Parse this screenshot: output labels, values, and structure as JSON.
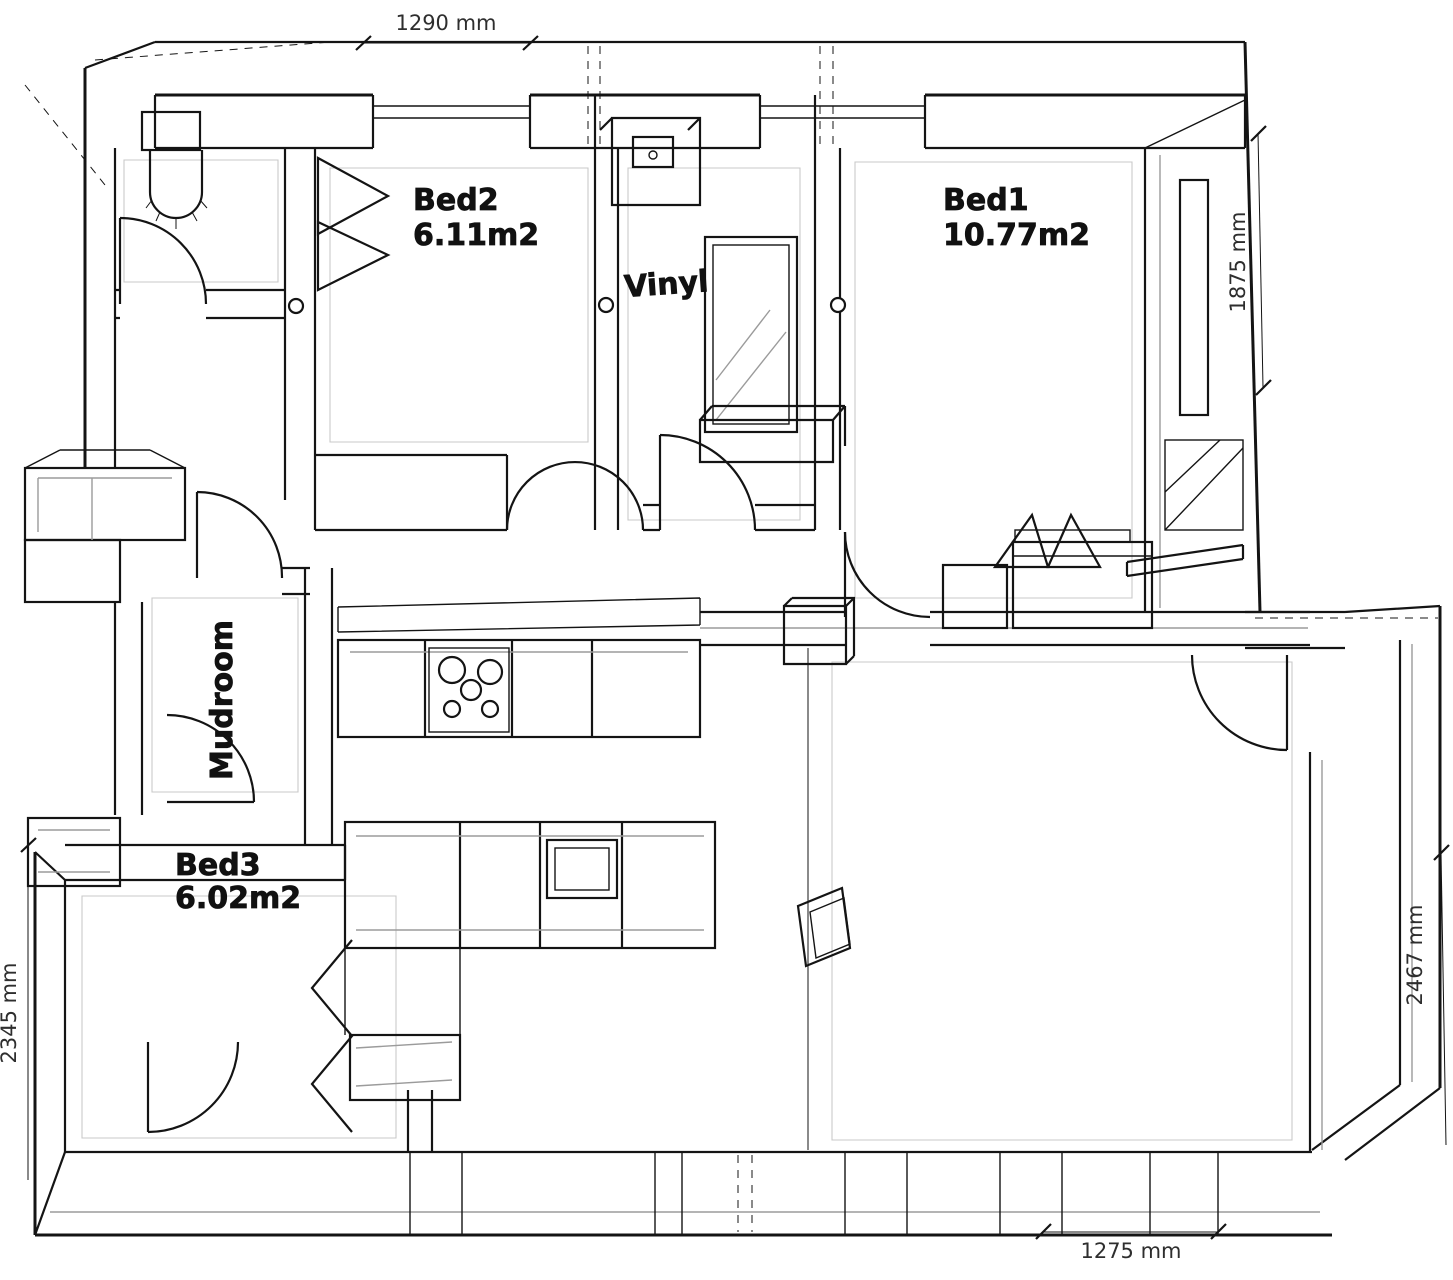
{
  "diagram": {
    "type": "3d-wireframe-floor-plan",
    "background": "#ffffff",
    "line_color": "#141414",
    "secondary_line_color": "#9b9b9b",
    "rooms": [
      {
        "id": "bed1",
        "name": "Bed1",
        "area": "10.77m2"
      },
      {
        "id": "bed2",
        "name": "Bed2",
        "area": "6.11m2"
      },
      {
        "id": "bed3",
        "name": "Bed3",
        "area": "6.02m2"
      },
      {
        "id": "mudroom",
        "name": "Mudroom",
        "area": ""
      },
      {
        "id": "vinyl",
        "name": "Vinyl",
        "area": ""
      }
    ],
    "dimensions": [
      {
        "id": "top",
        "text": "1290 mm"
      },
      {
        "id": "right-upper",
        "text": "1875 mm"
      },
      {
        "id": "right-lower",
        "text": "2467 mm"
      },
      {
        "id": "left",
        "text": "2345 mm"
      },
      {
        "id": "bottom",
        "text": "1275 mm"
      }
    ],
    "fixtures": [
      "toilet",
      "ceiling-lamp",
      "mirror-cabinet",
      "bed-with-pillows",
      "stove-5-burners",
      "kitchen-sink",
      "kitchen-counters",
      "wardrobe",
      "bay-window",
      "wall-panel"
    ]
  }
}
